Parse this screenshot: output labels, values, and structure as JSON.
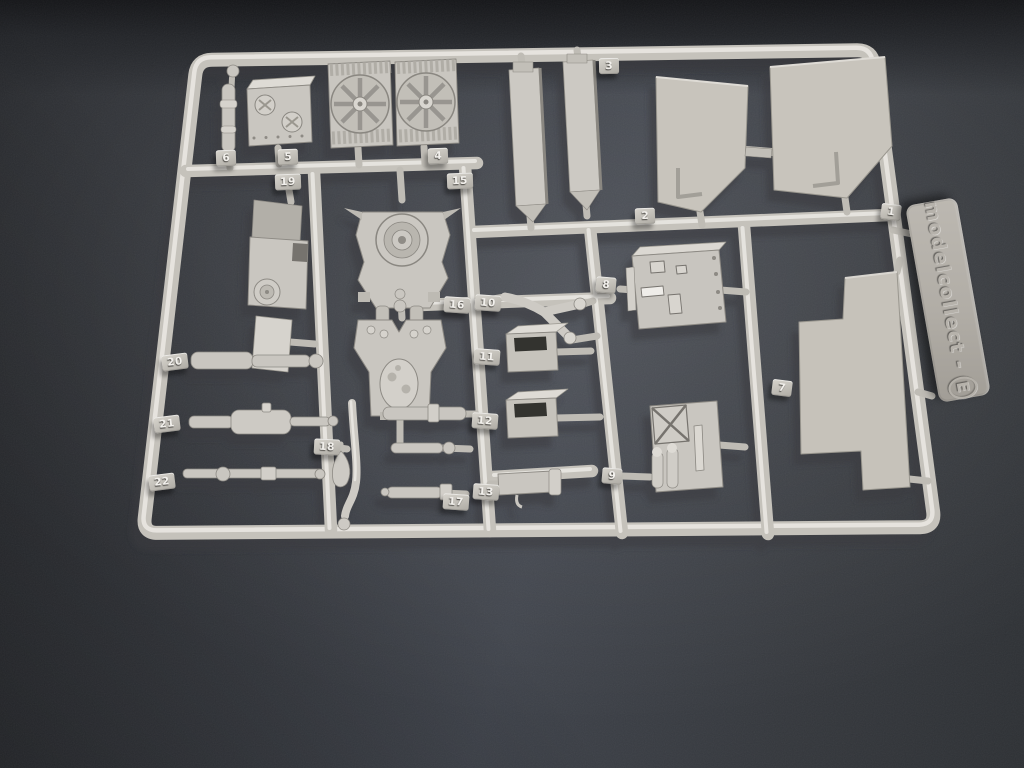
{
  "sprue": {
    "brand_tab": {
      "name": "modelcollect",
      "separator": "-",
      "letter": "E"
    },
    "part_tags": [
      {
        "number": "1"
      },
      {
        "number": "2"
      },
      {
        "number": "3"
      },
      {
        "number": "4"
      },
      {
        "number": "5"
      },
      {
        "number": "6"
      },
      {
        "number": "7"
      },
      {
        "number": "8"
      },
      {
        "number": "9"
      },
      {
        "number": "10"
      },
      {
        "number": "11"
      },
      {
        "number": "12"
      },
      {
        "number": "13"
      },
      {
        "number": "15"
      },
      {
        "number": "16"
      },
      {
        "number": "17"
      },
      {
        "number": "18"
      },
      {
        "number": "19"
      },
      {
        "number": "20"
      },
      {
        "number": "21"
      },
      {
        "number": "22"
      }
    ],
    "colors": {
      "plastic": "#c9c6c0",
      "plastic_highlight": "#e9e7e2",
      "plastic_shadow": "#8d8a84",
      "background": "#36393f",
      "background_dark": "#202225"
    }
  }
}
